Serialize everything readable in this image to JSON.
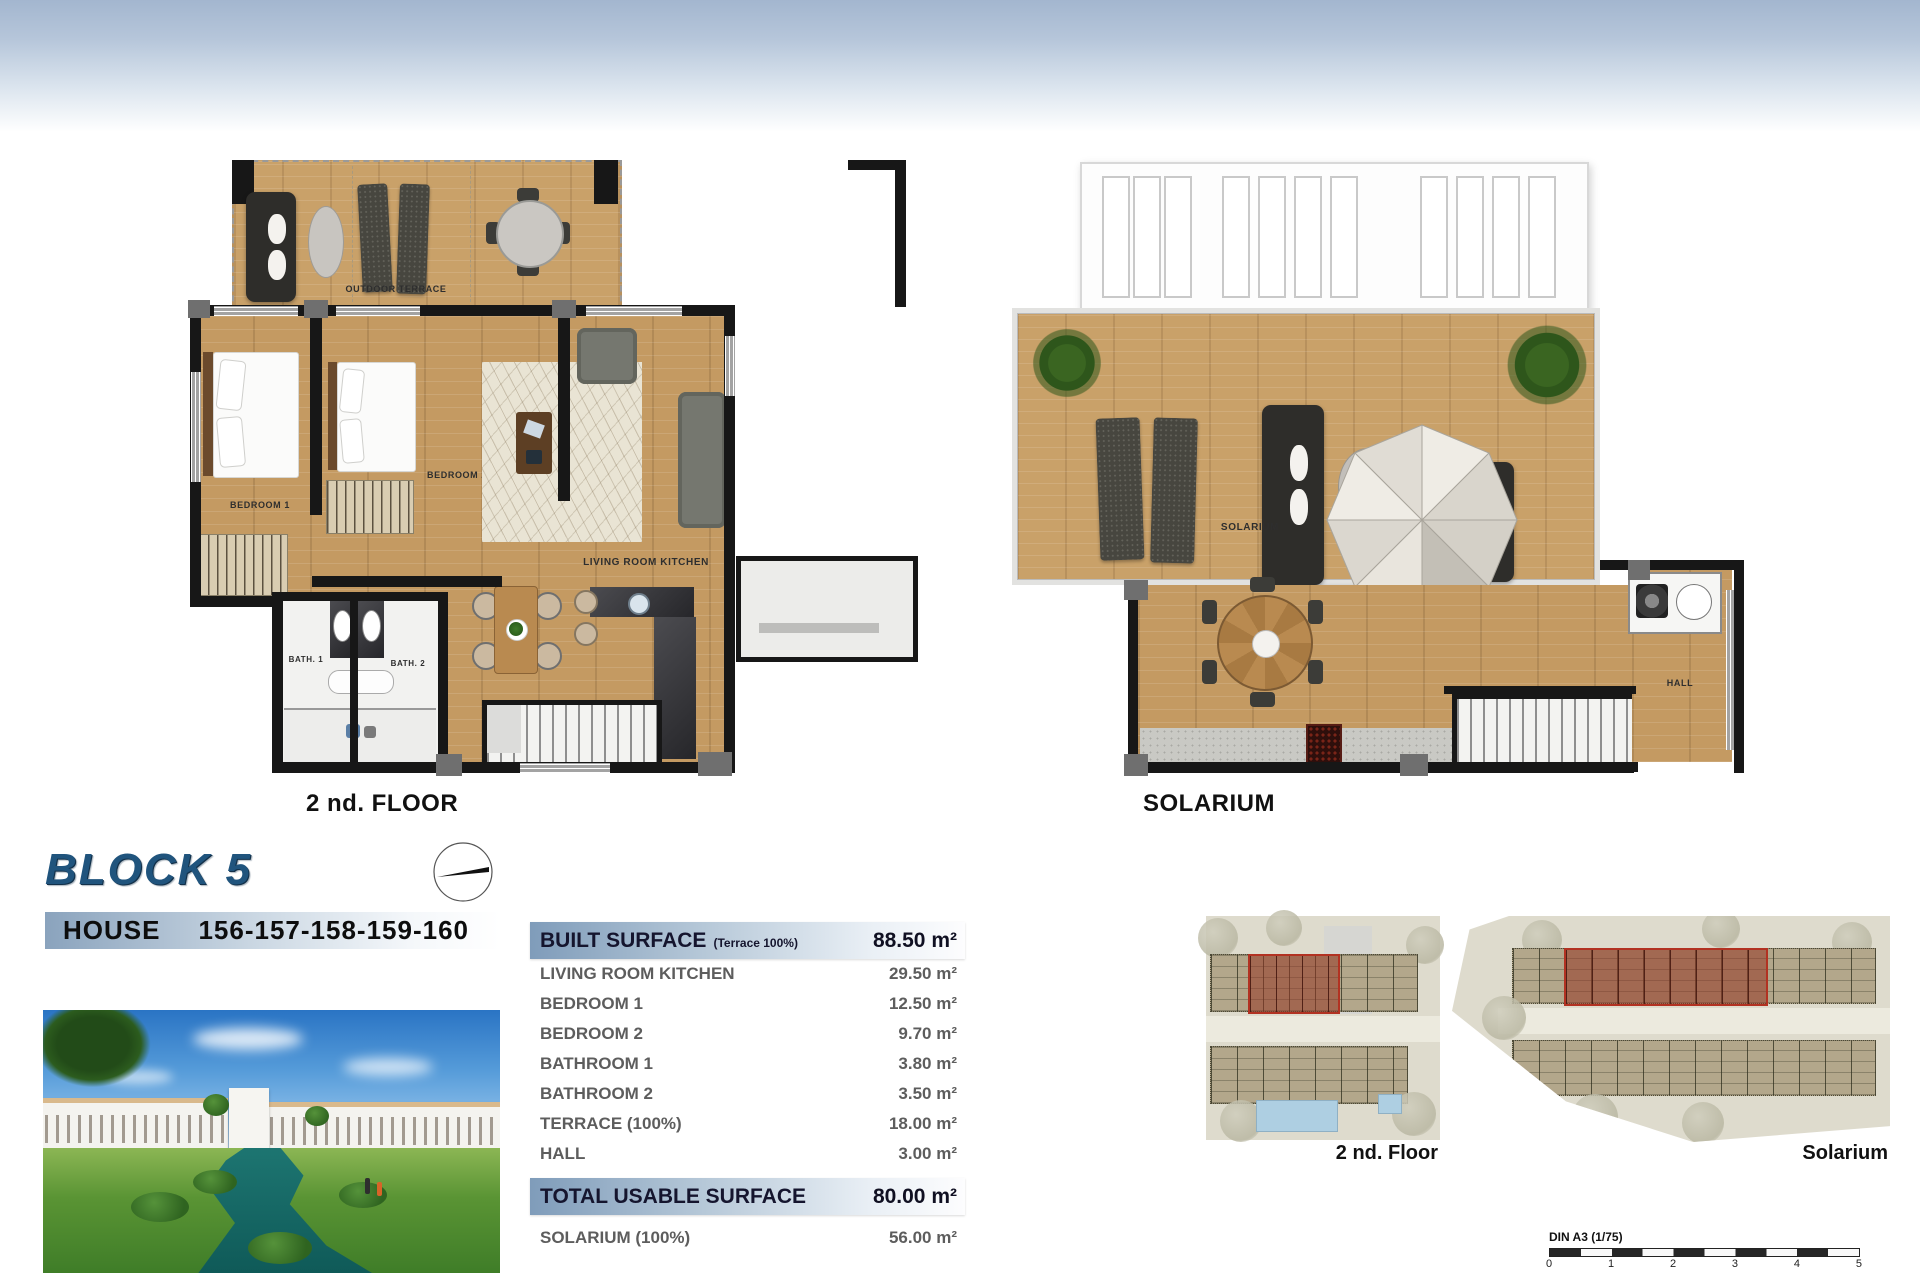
{
  "block": {
    "title": "BLOCK 5"
  },
  "house": {
    "label": "HOUSE",
    "numbers": "156-157-158-159-160"
  },
  "plan_second_floor": {
    "caption": "2 nd. FLOOR",
    "labels": {
      "outdoor_terrace": "OUTDOOR TERRACE",
      "bedroom1": "BEDROOM 1",
      "bedroom2": "BEDROOM 2",
      "living": "LIVING ROOM KITCHEN",
      "bath1": "BATH. 1",
      "bath2": "BATH. 2"
    }
  },
  "plan_solarium": {
    "caption": "SOLARIUM",
    "labels": {
      "solarium": "SOLARIUM",
      "hall": "HALL"
    }
  },
  "surface_table": {
    "header_label": "BUILT SURFACE",
    "header_sub": "(Terrace 100%)",
    "header_value": "88.50 m²",
    "rows": [
      {
        "label": "LIVING ROOM KITCHEN",
        "value": "29.50 m²"
      },
      {
        "label": "BEDROOM 1",
        "value": "12.50 m²"
      },
      {
        "label": "BEDROOM 2",
        "value": "9.70 m²"
      },
      {
        "label": "BATHROOM 1",
        "value": "3.80 m²"
      },
      {
        "label": "BATHROOM 2",
        "value": "3.50 m²"
      },
      {
        "label": "TERRACE (100%)",
        "value": "18.00 m²"
      },
      {
        "label": "HALL",
        "value": "3.00 m²"
      }
    ],
    "total_label": "TOTAL USABLE SURFACE",
    "total_value": "80.00 m²",
    "solarium_label": "SOLARIUM (100%)",
    "solarium_value": "56.00 m²"
  },
  "site_plans": {
    "second_floor_caption": "2 nd. Floor",
    "solarium_caption": "Solarium"
  },
  "scale_bar": {
    "label": "DIN A3 (1/75)",
    "ticks": [
      "0",
      "1",
      "2",
      "3",
      "4",
      "5"
    ]
  },
  "colors": {
    "accent_blue": "#20547d",
    "table_gradient": "#7f9cba",
    "highlight_red": "#b23222",
    "wood": "#c49a62"
  }
}
